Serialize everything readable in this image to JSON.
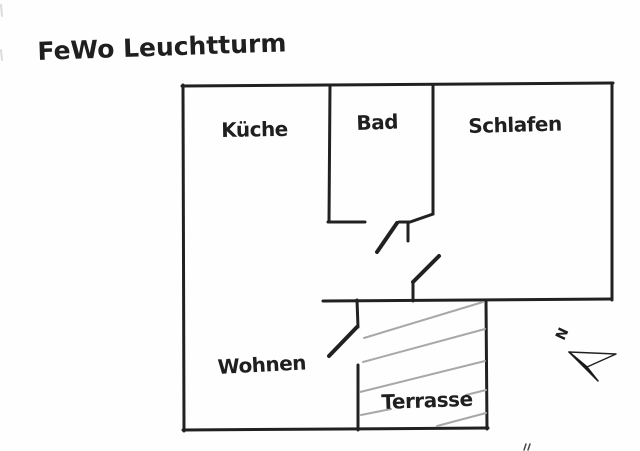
{
  "title": "FeWo Leuchtturm",
  "rooms": {
    "kueche": "Küche",
    "bad": "Bad",
    "schlafen": "Schlafen",
    "wohnen": "Wohnen",
    "terrasse": "Terrasse"
  },
  "compass": {
    "north_label": "N"
  },
  "colors": {
    "ink": "#212121",
    "hatch": "#a8a8a8",
    "background": "#fefefe"
  }
}
